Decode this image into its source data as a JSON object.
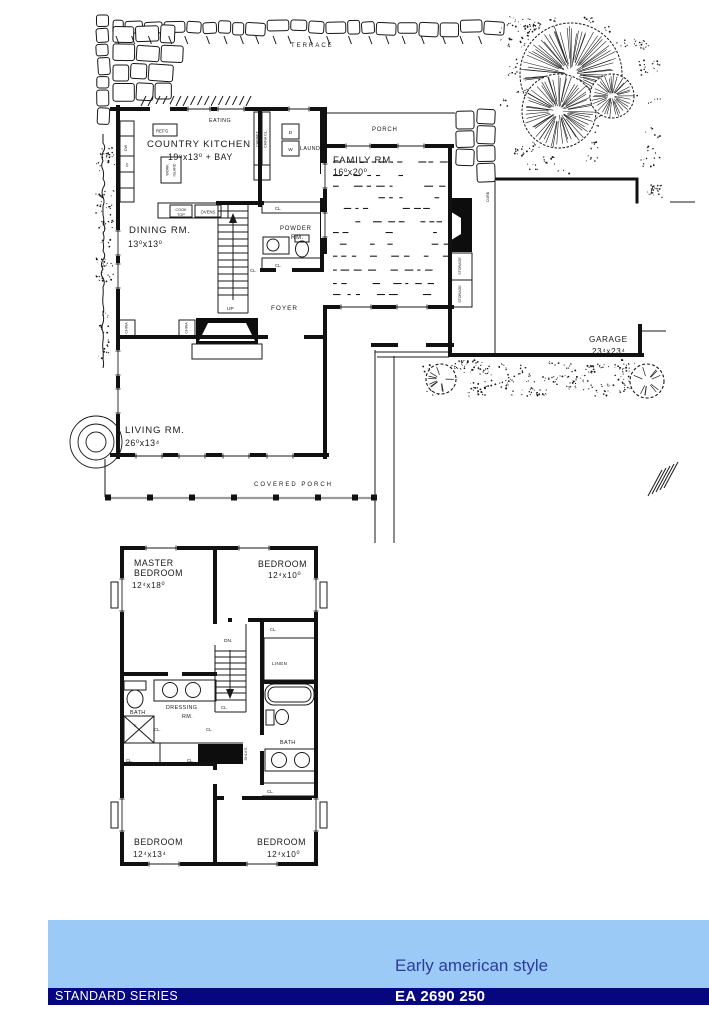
{
  "first_floor": {
    "terrace": "TERRACE",
    "eating": "EATING",
    "country_kitchen": {
      "name": "COUNTRY KITCHEN",
      "dims": "19⁸x13⁰ + BAY"
    },
    "refrigerator": "REF'G",
    "work_island": {
      "line1": "WORK",
      "line2": "ISLAND"
    },
    "cook_top": {
      "line1": "COOK",
      "line2": "TOP"
    },
    "ovens": "OVENS",
    "cabinet": "CABINET",
    "china_closet": "CHINA CL.",
    "pantry": "P'TRY",
    "dryer": "D",
    "washer": "W",
    "laundry": "LAUND",
    "dishwasher": "DW",
    "sink": "S",
    "porch": "PORCH",
    "family_room": {
      "name": "FAMILY RM.",
      "dims": "16⁰x20⁰"
    },
    "dining_room": {
      "name": "DINING RM.",
      "dims": "13⁰x13⁰"
    },
    "powder_room": {
      "line1": "POWDER",
      "line2": "RM."
    },
    "foyer": "FOYER",
    "up": "UP",
    "china": "CHINA",
    "living_room": {
      "name": "LIVING RM.",
      "dims": "26⁰x13⁴"
    },
    "covered_porch": "COVERED PORCH",
    "storage": "STORAGE",
    "curb": "CURB",
    "garage": {
      "name": "GARAGE",
      "dims": "23⁴x23⁴"
    },
    "closet": "CL."
  },
  "second_floor": {
    "master_bedroom": {
      "line1": "MASTER",
      "line2": "BEDROOM",
      "dims": "12⁴x18⁰"
    },
    "bedroom_2": {
      "name": "BEDROOM",
      "dims": "12⁴x10⁰"
    },
    "bedroom_3": {
      "name": "BEDROOM",
      "dims": "12⁴x13⁴"
    },
    "bedroom_4": {
      "name": "BEDROOM",
      "dims": "12⁴x10⁰"
    },
    "down": "DN.",
    "linen": "LINEN",
    "bath": "BATH",
    "dressing_room": {
      "line1": "DRESSING",
      "line2": "RM."
    },
    "shelves": "SHLV'S",
    "closet": "CL.",
    "shower": "S"
  },
  "footer": {
    "style_label": "Early american style",
    "series_label": "STANDARD SERIES",
    "plan_number": "EA 2690 250",
    "banner_color": "#9CCAF7",
    "bar_color": "#06067F",
    "style_text_color": "#2C3C9C"
  }
}
